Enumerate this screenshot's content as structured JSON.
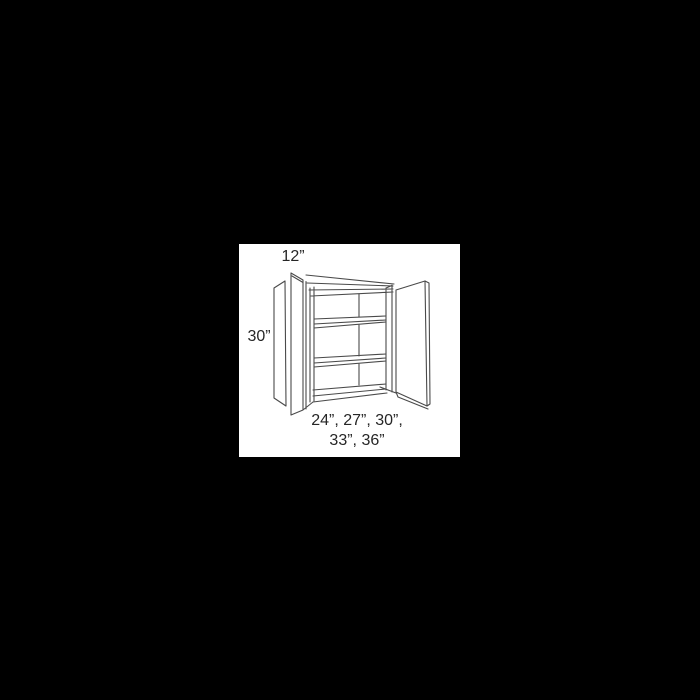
{
  "canvas": {
    "background_color": "#000000",
    "panel_background_color": "#ffffff"
  },
  "diagram": {
    "type": "cabinet-line-drawing",
    "subject": "Two-door wall cabinet shown in perspective with both doors open and three interior shelves",
    "line_color": "#4a4a4a",
    "text_color": "#262626",
    "labels": {
      "depth": "12”",
      "height": "30”",
      "widths_line1": "24”, 27”, 30”,",
      "widths_line2": "33”, 36”"
    },
    "dimensions": {
      "depth_inches": 12,
      "height_inches": 30,
      "width_options_inches": [
        24,
        27,
        30,
        33,
        36
      ]
    }
  }
}
